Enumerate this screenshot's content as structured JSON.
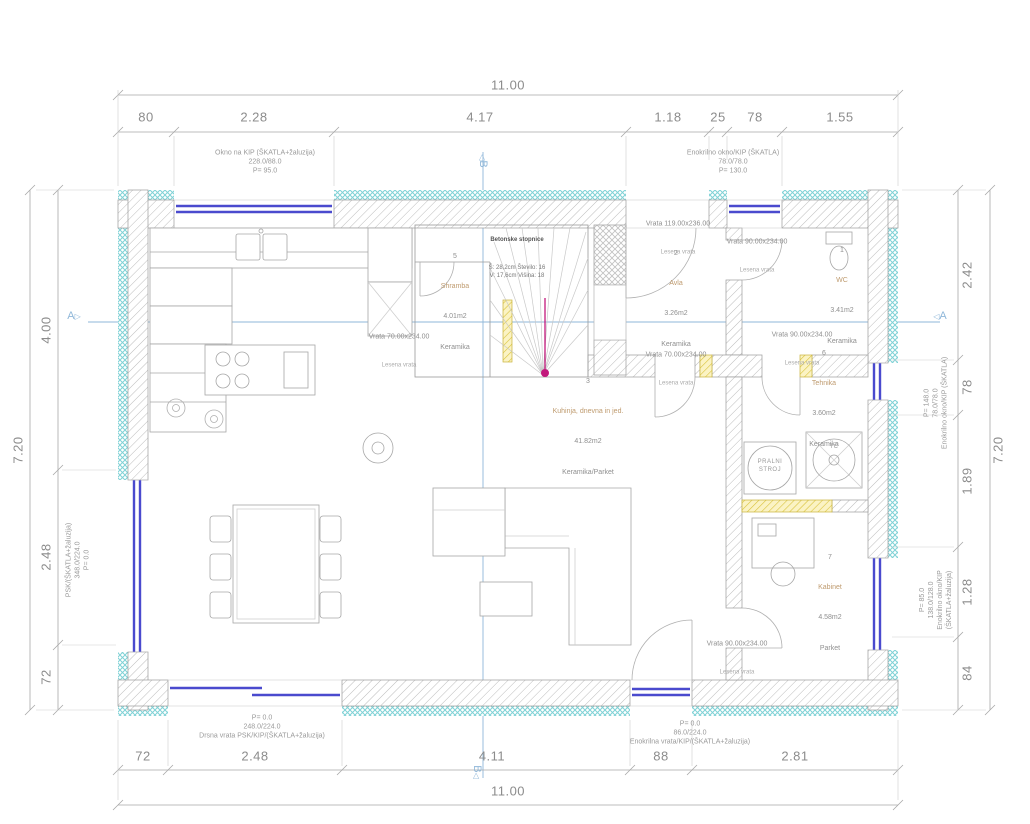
{
  "plan": {
    "section_a": "A",
    "section_b": "B",
    "icons": {
      "tri_right": "▷",
      "tri_left": "◁"
    }
  },
  "dims": {
    "top": {
      "overall": "11.00",
      "segments": [
        "80",
        "2.28",
        "4.17",
        "1.18",
        "25",
        "78",
        "1.55"
      ]
    },
    "bottom": {
      "overall": "11.00",
      "segments": [
        "72",
        "2.48",
        "4.11",
        "88",
        "2.81"
      ]
    },
    "left": {
      "overall": "7.20",
      "segments": [
        "4.00",
        "2.48",
        "72"
      ]
    },
    "right": {
      "overall": "7.20",
      "segments": [
        "2.42",
        "78",
        "1.89",
        "1.28",
        "84"
      ]
    }
  },
  "notes": {
    "top_left": "Okno na KIP (ŠKATLA+žaluzija)\n228.0/88.0\nP= 95.0",
    "top_right": "Enokrilno okno/KIP (ŠKATLA)\n78.0/78.0\nP= 130.0",
    "left": "PSK/(ŠKATLA+žaluzija)\n348.0/224.0\nP= 0.0",
    "right_upper": "P= 148.0\n78.0/78.0\nEnokrilno okno/KIP (ŠKATLA)",
    "right_lower": "P= 85.0\n138.0/128.0\nEnokrilno okno/KIP (ŠKATLA+žaluzija)",
    "bottom_left": "P= 0.0\n248.0/224.0\nDrsna vrata PSK/KIP/(ŠKATLA+žaluzija)",
    "bottom_right": "P= 0.0\n86.0/224.0\nEnokrilna vrata/KIP/(ŠKATLA+žaluzija)"
  },
  "rooms": [
    {
      "num": "1",
      "name": "WC",
      "area": "3.41m2",
      "floor": "Keramika"
    },
    {
      "num": "2",
      "name": "Avla",
      "area": "3.26m2",
      "floor": "Keramika"
    },
    {
      "num": "3",
      "name": "Kuhinja, dnevna in jed.",
      "area": "41.82m2",
      "floor": "Keramika/Parket"
    },
    {
      "num": "5",
      "name": "Shramba",
      "area": "4.01m2",
      "floor": "Keramika"
    },
    {
      "num": "6",
      "name": "Tehnika",
      "area": "3.60m2",
      "floor": "Keramika"
    },
    {
      "num": "7",
      "name": "Kabinet",
      "area": "4.58m2",
      "floor": "Parket"
    }
  ],
  "doors": [
    {
      "label": "Vrata 119.00x236.00",
      "sub": "Lesena vrata"
    },
    {
      "label": "Vrata 90.00x234.00",
      "sub": "Lesena vrata"
    },
    {
      "label": "Vrata 70.00x234.00",
      "sub": "Lesena vrata"
    },
    {
      "label": "Vrata 70.00x234.00",
      "sub": "Lesena vrata"
    },
    {
      "label": "Vrata 90.00x234.00",
      "sub": "Lesena vrata"
    },
    {
      "label": "Vrata 90.00x234.00",
      "sub": "Lesena vrata"
    }
  ],
  "stairs": {
    "title": "Betonske stopnice",
    "spec": "Š: 28,2cm  Število: 16\nV: 17,6cm  Višina: 18"
  },
  "equipment": {
    "washer": "PRALNI\nSTROJ",
    "heat_pump": "TČ"
  }
}
